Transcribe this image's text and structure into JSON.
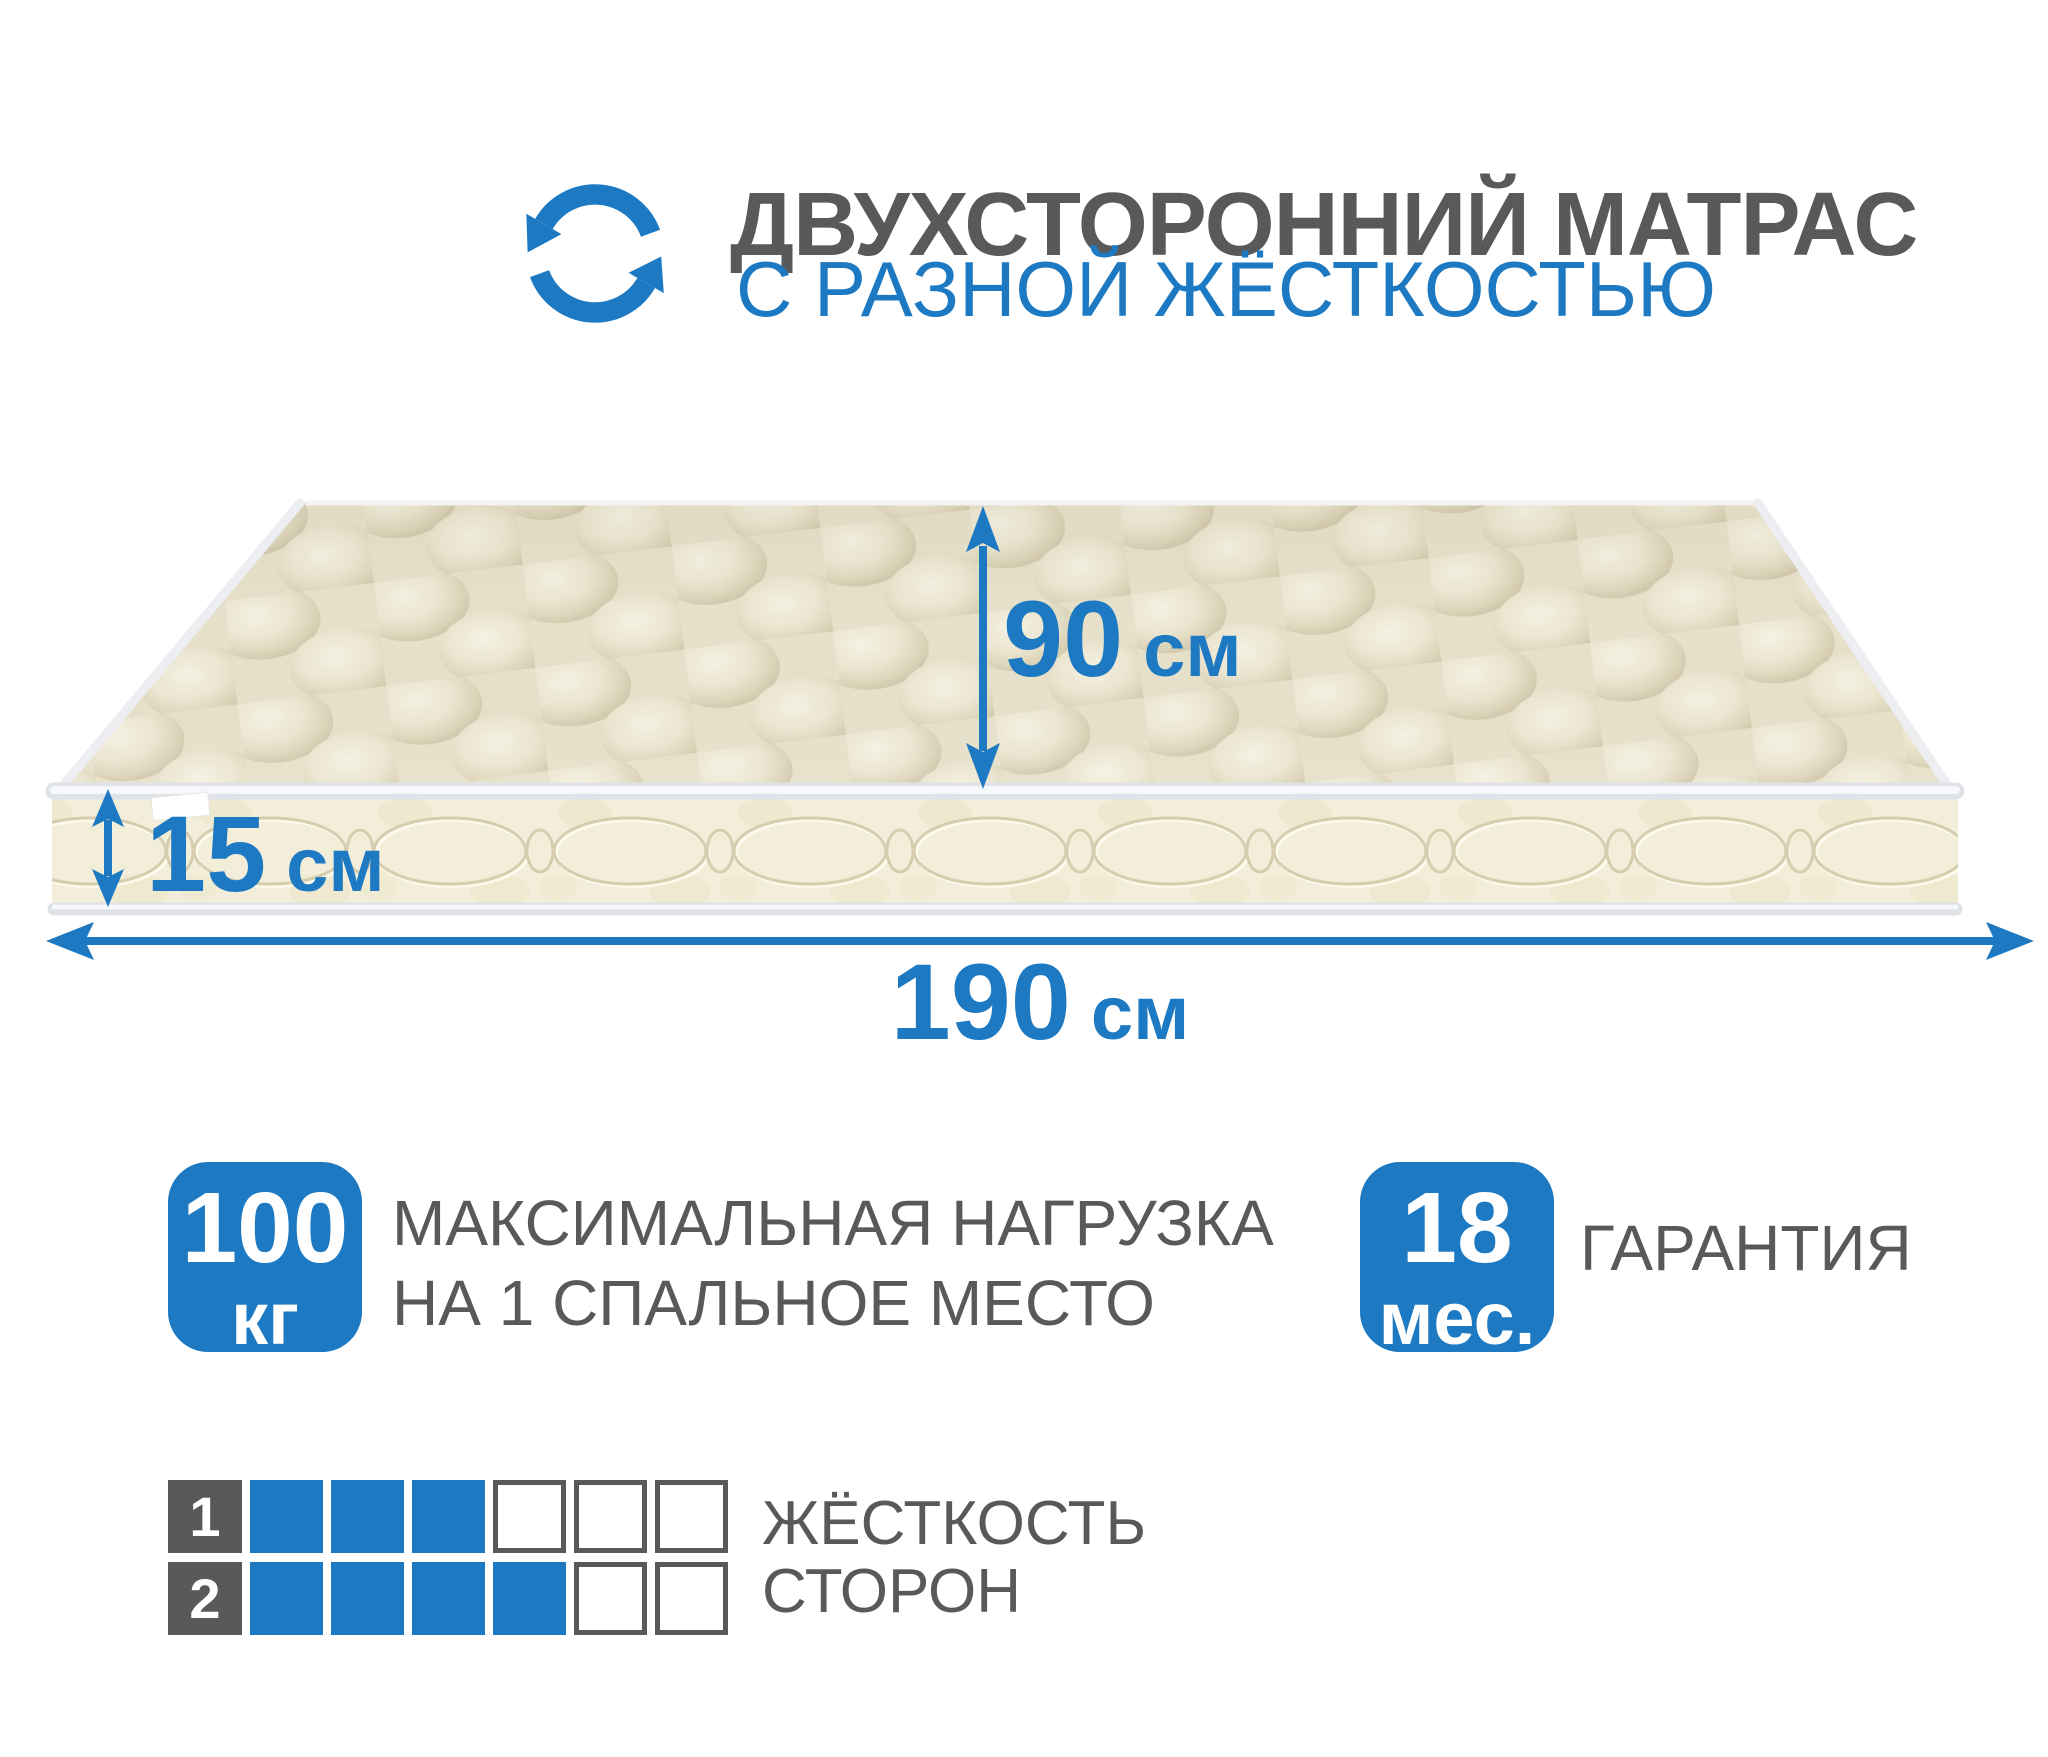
{
  "header": {
    "icon": "rotate-arrows",
    "title": "ДВУХСТОРОННИЙ МАТРАС",
    "subtitle": "С РАЗНОЙ ЖЁСТКОСТЬЮ"
  },
  "dimensions": {
    "depth": {
      "value": "90",
      "unit": "см"
    },
    "thickness": {
      "value": "15",
      "unit": "см"
    },
    "length": {
      "value": "190",
      "unit": "см"
    }
  },
  "features": {
    "max_load": {
      "badge_value": "100",
      "badge_unit": "кг",
      "line1": "МАКСИМАЛЬНАЯ НАГРУЗКА",
      "line2": "НА 1 СПАЛЬНОЕ МЕСТО"
    },
    "warranty": {
      "badge_value": "18",
      "badge_unit": "мес.",
      "label": "ГАРАНТИЯ"
    }
  },
  "hardness": {
    "caption_line1": "ЖЁСТКОСТЬ",
    "caption_line2": "СТОРОН",
    "scale_max": 6,
    "rows": [
      {
        "side": "1",
        "filled": 3
      },
      {
        "side": "2",
        "filled": 4
      }
    ]
  },
  "colors": {
    "accent_blue": "#1c79c2",
    "text_gray": "#58595b",
    "fabric_beige": "#eae5d0"
  }
}
